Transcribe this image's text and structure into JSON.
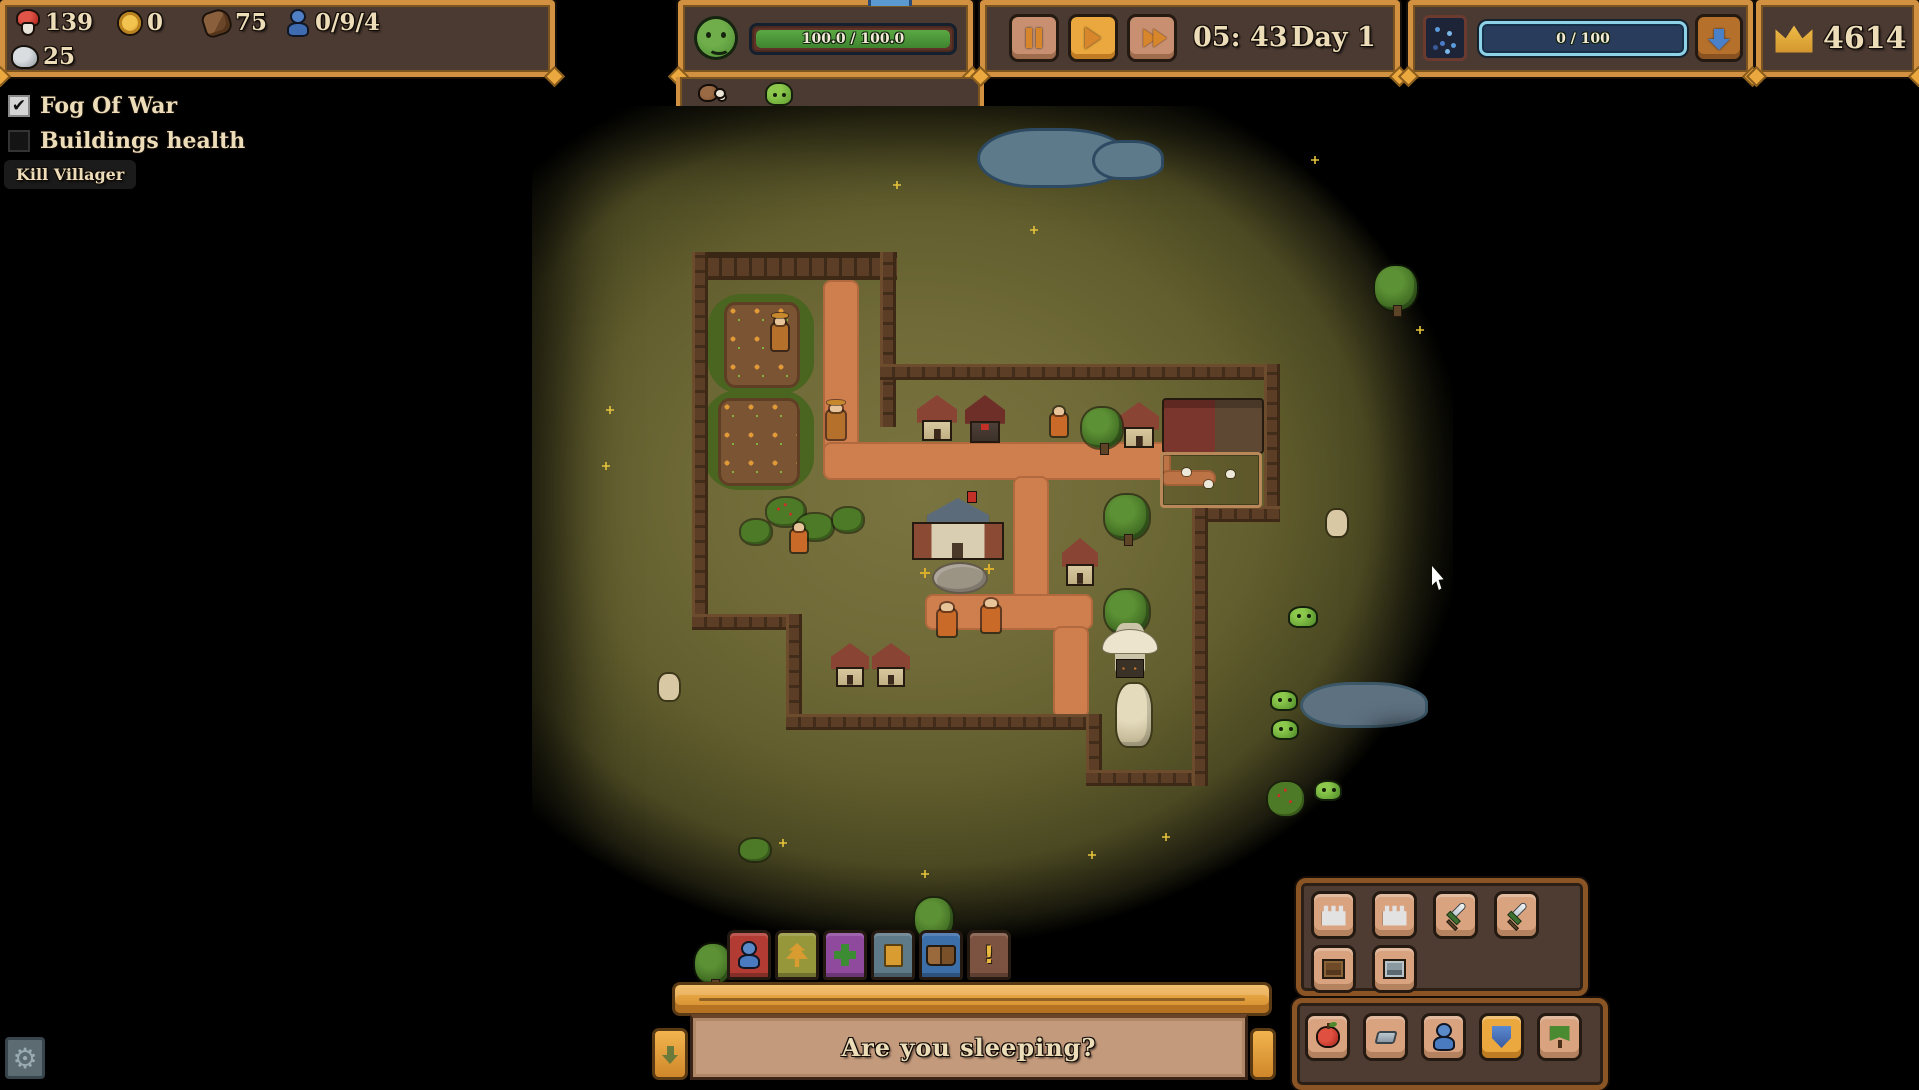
{
  "top_bar": {
    "resources": {
      "food": "139",
      "gold": "0",
      "wood": "75",
      "villagers": "0/9/4",
      "stone": "25"
    },
    "happiness_bar": "100.0  /  100.0",
    "time": {
      "clock": "05: 43",
      "day": "Day 1"
    },
    "mana_bar": "0  /  100",
    "crown_score": "4614"
  },
  "debug_panel": {
    "fog_of_war_label": "Fog Of War",
    "fog_of_war_checked": "✔",
    "buildings_health_label": "Buildings health",
    "kill_villager_label": "Kill Villager"
  },
  "banner": {
    "message": "Are you sleeping?"
  },
  "settings": {
    "gear_glyph": "⚙"
  },
  "toolbar": {
    "tabs": [
      {
        "name": "tab-villagers",
        "color": "#b23c34",
        "icon": "ti-person"
      },
      {
        "name": "tab-nature",
        "color": "#96973b",
        "icon": "ti-tree"
      },
      {
        "name": "tab-health",
        "color": "#8f4a9e",
        "icon": "ti-cross"
      },
      {
        "name": "tab-cards",
        "color": "#5e7a88",
        "icon": "ti-cards"
      },
      {
        "name": "tab-journal",
        "color": "#3c6ea8",
        "icon": "ti-book"
      },
      {
        "name": "tab-alerts",
        "color": "#7c5340",
        "icon": "ti-exclaim",
        "glyph": "!"
      }
    ]
  },
  "build_menu": {
    "row1": [
      {
        "name": "build-tower-1",
        "icon": "bi-tower"
      },
      {
        "name": "build-tower-2",
        "icon": "bi-tower"
      },
      {
        "name": "build-sword-1",
        "icon": "bi-sword"
      },
      {
        "name": "build-sword-2",
        "icon": "bi-sword"
      }
    ],
    "row2": [
      {
        "name": "build-crate-wood",
        "icon": "bi-crate-wood"
      },
      {
        "name": "build-crate-metal",
        "icon": "bi-crate-metal"
      }
    ],
    "bottom_row": [
      {
        "name": "resource-apple",
        "icon": "bi-apple"
      },
      {
        "name": "resource-ingot",
        "icon": "bi-ingot"
      },
      {
        "name": "resource-villager",
        "icon": "bi-person"
      },
      {
        "name": "resource-shield",
        "icon": "bi-shield",
        "selected": true
      },
      {
        "name": "resource-banner",
        "icon": "bi-banner-tree"
      }
    ]
  },
  "cursor": {
    "x": 1432,
    "y": 566
  },
  "map": {
    "entities": [
      {
        "t": "pond",
        "x": 445,
        "y": 22,
        "w": 150,
        "h": 60
      },
      {
        "t": "pond",
        "x": 560,
        "y": 34,
        "w": 72,
        "h": 40
      },
      {
        "t": "pond-gray",
        "x": 768,
        "y": 576,
        "w": 128,
        "h": 46
      },
      {
        "t": "path",
        "x": 291,
        "y": 174,
        "w": 36,
        "h": 180
      },
      {
        "t": "path",
        "x": 291,
        "y": 336,
        "w": 348,
        "h": 38
      },
      {
        "t": "path",
        "x": 481,
        "y": 370,
        "w": 36,
        "h": 124
      },
      {
        "t": "path",
        "x": 393,
        "y": 488,
        "w": 168,
        "h": 36
      },
      {
        "t": "path",
        "x": 521,
        "y": 520,
        "w": 36,
        "h": 92
      },
      {
        "t": "path",
        "x": 628,
        "y": 364,
        "w": 56,
        "h": 16
      },
      {
        "t": "farm-grass",
        "x": 176,
        "y": 188,
        "w": 106,
        "h": 100
      },
      {
        "t": "farm-soil",
        "x": 192,
        "y": 196,
        "w": 76,
        "h": 86
      },
      {
        "t": "farm-grass",
        "x": 172,
        "y": 284,
        "w": 110,
        "h": 100
      },
      {
        "t": "farm-soil",
        "x": 186,
        "y": 292,
        "w": 82,
        "h": 88
      },
      {
        "t": "wall-top",
        "x": 160,
        "y": 146,
        "w": 205,
        "h": 28
      },
      {
        "t": "wall-v",
        "x": 160,
        "y": 146,
        "w": 16,
        "h": 378
      },
      {
        "t": "wall-h",
        "x": 160,
        "y": 508,
        "w": 110,
        "h": 16
      },
      {
        "t": "wall-v",
        "x": 254,
        "y": 508,
        "w": 16,
        "h": 116
      },
      {
        "t": "wall-h",
        "x": 254,
        "y": 608,
        "w": 316,
        "h": 16
      },
      {
        "t": "wall-v",
        "x": 554,
        "y": 608,
        "w": 16,
        "h": 72
      },
      {
        "t": "wall-h",
        "x": 554,
        "y": 664,
        "w": 122,
        "h": 16
      },
      {
        "t": "wall-v",
        "x": 348,
        "y": 146,
        "w": 16,
        "h": 175
      },
      {
        "t": "wall-h",
        "x": 348,
        "y": 258,
        "w": 400,
        "h": 16
      },
      {
        "t": "wall-v",
        "x": 732,
        "y": 258,
        "w": 16,
        "h": 158
      },
      {
        "t": "wall-h",
        "x": 660,
        "y": 400,
        "w": 88,
        "h": 16
      },
      {
        "t": "wall-v",
        "x": 660,
        "y": 400,
        "w": 16,
        "h": 280
      },
      {
        "t": "house",
        "x": 385,
        "y": 289,
        "w": 40,
        "h": 46
      },
      {
        "t": "barracks",
        "x": 433,
        "y": 289,
        "w": 40,
        "h": 48
      },
      {
        "t": "house",
        "x": 587,
        "y": 296,
        "w": 40,
        "h": 46
      },
      {
        "t": "stable",
        "x": 630,
        "y": 292,
        "w": 98,
        "h": 52
      },
      {
        "t": "fence",
        "x": 628,
        "y": 346,
        "w": 96,
        "h": 50
      },
      {
        "t": "chicken",
        "x": 650,
        "y": 362,
        "w": 9,
        "h": 8
      },
      {
        "t": "chicken",
        "x": 672,
        "y": 374,
        "w": 9,
        "h": 8
      },
      {
        "t": "chicken",
        "x": 694,
        "y": 364,
        "w": 9,
        "h": 8
      },
      {
        "t": "townhall",
        "x": 380,
        "y": 392,
        "w": 92,
        "h": 62
      },
      {
        "t": "flag",
        "x": 436,
        "y": 386,
        "w": 8,
        "h": 10
      },
      {
        "t": "patio",
        "x": 400,
        "y": 456,
        "w": 52,
        "h": 28
      },
      {
        "t": "house",
        "x": 530,
        "y": 432,
        "w": 36,
        "h": 48
      },
      {
        "t": "house",
        "x": 299,
        "y": 537,
        "w": 38,
        "h": 44
      },
      {
        "t": "house",
        "x": 340,
        "y": 537,
        "w": 38,
        "h": 44
      },
      {
        "t": "tree",
        "x": 573,
        "y": 389,
        "w": 44,
        "h": 44
      },
      {
        "t": "tree",
        "x": 573,
        "y": 484,
        "w": 44,
        "h": 44
      },
      {
        "t": "tree",
        "x": 550,
        "y": 302,
        "w": 40,
        "h": 40
      },
      {
        "t": "tree",
        "x": 843,
        "y": 160,
        "w": 42,
        "h": 44
      },
      {
        "t": "tree",
        "x": 383,
        "y": 792,
        "w": 38,
        "h": 42
      },
      {
        "t": "tree",
        "x": 163,
        "y": 838,
        "w": 36,
        "h": 40
      },
      {
        "t": "bush-berry",
        "x": 235,
        "y": 392,
        "w": 38,
        "h": 28
      },
      {
        "t": "bush",
        "x": 265,
        "y": 408,
        "w": 36,
        "h": 26
      },
      {
        "t": "bush",
        "x": 209,
        "y": 414,
        "w": 30,
        "h": 24
      },
      {
        "t": "bush",
        "x": 301,
        "y": 402,
        "w": 30,
        "h": 24
      },
      {
        "t": "bush",
        "x": 208,
        "y": 733,
        "w": 30,
        "h": 22
      },
      {
        "t": "bush-berry",
        "x": 736,
        "y": 676,
        "w": 36,
        "h": 34
      },
      {
        "t": "statue",
        "x": 583,
        "y": 517,
        "w": 30,
        "h": 50
      },
      {
        "t": "rock",
        "x": 585,
        "y": 578,
        "w": 34,
        "h": 62
      },
      {
        "t": "villager",
        "x": 406,
        "y": 504,
        "w": 18,
        "h": 26
      },
      {
        "t": "villager",
        "x": 450,
        "y": 500,
        "w": 18,
        "h": 26
      },
      {
        "t": "villager",
        "x": 259,
        "y": 424,
        "w": 16,
        "h": 22
      },
      {
        "t": "villager",
        "x": 519,
        "y": 308,
        "w": 16,
        "h": 22
      },
      {
        "t": "farmer",
        "x": 295,
        "y": 305,
        "w": 18,
        "h": 28
      },
      {
        "t": "farmer",
        "x": 240,
        "y": 218,
        "w": 16,
        "h": 26
      },
      {
        "t": "goat",
        "x": 795,
        "y": 404,
        "w": 20,
        "h": 26
      },
      {
        "t": "goat",
        "x": 127,
        "y": 568,
        "w": 20,
        "h": 26
      },
      {
        "t": "slime",
        "x": 756,
        "y": 500,
        "w": 30,
        "h": 22
      },
      {
        "t": "slime",
        "x": 738,
        "y": 584,
        "w": 28,
        "h": 21
      },
      {
        "t": "slime",
        "x": 739,
        "y": 613,
        "w": 28,
        "h": 21
      },
      {
        "t": "slime",
        "x": 782,
        "y": 674,
        "w": 28,
        "h": 21
      },
      {
        "t": "flower",
        "x": 388,
        "y": 462
      },
      {
        "t": "flower",
        "x": 452,
        "y": 458
      },
      {
        "t": "sparkle",
        "x": 361,
        "y": 75
      },
      {
        "t": "sparkle",
        "x": 74,
        "y": 300
      },
      {
        "t": "sparkle",
        "x": 70,
        "y": 356
      },
      {
        "t": "sparkle",
        "x": 247,
        "y": 733
      },
      {
        "t": "sparkle",
        "x": 389,
        "y": 764
      },
      {
        "t": "sparkle",
        "x": 556,
        "y": 745
      },
      {
        "t": "sparkle",
        "x": 630,
        "y": 727
      },
      {
        "t": "sparkle",
        "x": 884,
        "y": 220
      },
      {
        "t": "sparkle",
        "x": 779,
        "y": 50
      },
      {
        "t": "sparkle",
        "x": 498,
        "y": 120
      },
      {
        "t": "notch",
        "x": 863,
        "y": 625,
        "w": 58,
        "h": 252
      }
    ]
  }
}
